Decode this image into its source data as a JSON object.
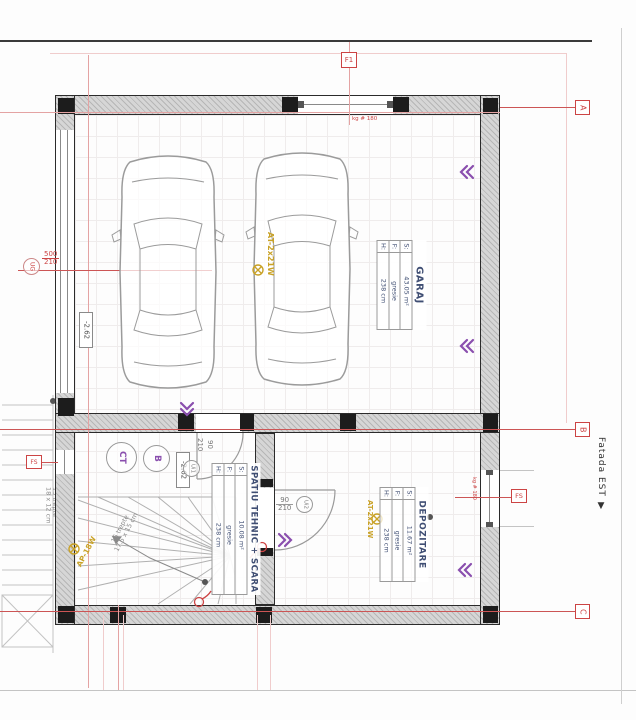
{
  "colors": {
    "accent_red": "#cc4444",
    "purple": "#8a4fae",
    "yellow": "#c9a227",
    "slate_blue": "#3f4e73",
    "wall_gray": "#d6d6d6"
  },
  "rooms": [
    {
      "name": "GARAJ",
      "rows": [
        {
          "k": "S:",
          "v": "43.05 m²"
        },
        {
          "k": "F:",
          "v": "gresie"
        },
        {
          "k": "H:",
          "v": "238 cm"
        }
      ]
    },
    {
      "name": "SPATIU TEHNIC + SCARA",
      "rows": [
        {
          "k": "S:",
          "v": "10.08 m²"
        },
        {
          "k": "F:",
          "v": "gresie"
        },
        {
          "k": "H:",
          "v": "238 cm"
        }
      ]
    },
    {
      "name": "DEPOZITARE",
      "rows": [
        {
          "k": "S:",
          "v": "11.67 m²"
        },
        {
          "k": "F:",
          "v": "gresie"
        },
        {
          "k": "H:",
          "v": "238 cm"
        }
      ]
    }
  ],
  "doors": {
    "garage": {
      "id": "UG",
      "w": "500",
      "h": "210"
    },
    "tech": {
      "id": "Ui1",
      "w": "90",
      "h": "210"
    },
    "storage": {
      "id": "Ui2",
      "w": "90",
      "h": "210"
    }
  },
  "windows": {
    "top": {
      "id": "F1",
      "note": "kg # 180"
    },
    "right": {
      "id": "FS",
      "note": "kg # 180"
    },
    "left": {
      "id": "FS"
    }
  },
  "levels": {
    "garage": "-2.62",
    "tech": "-2.62"
  },
  "stairs": {
    "interior_line1": "16 trepte",
    "interior_line2": "17.5 x 15 cm",
    "exterior_line1": "13 trepte",
    "exterior_line2": "18 x 12 cm"
  },
  "lighting": {
    "garage": "AT-2x21W",
    "storage": "AT-2x21W",
    "stair": "AP-18W"
  },
  "equipment": {
    "ct": "CT",
    "b": "B"
  },
  "grid_markers": {
    "a": "A",
    "b": "B",
    "c": "C"
  },
  "facade": "Fatada EST ▼"
}
